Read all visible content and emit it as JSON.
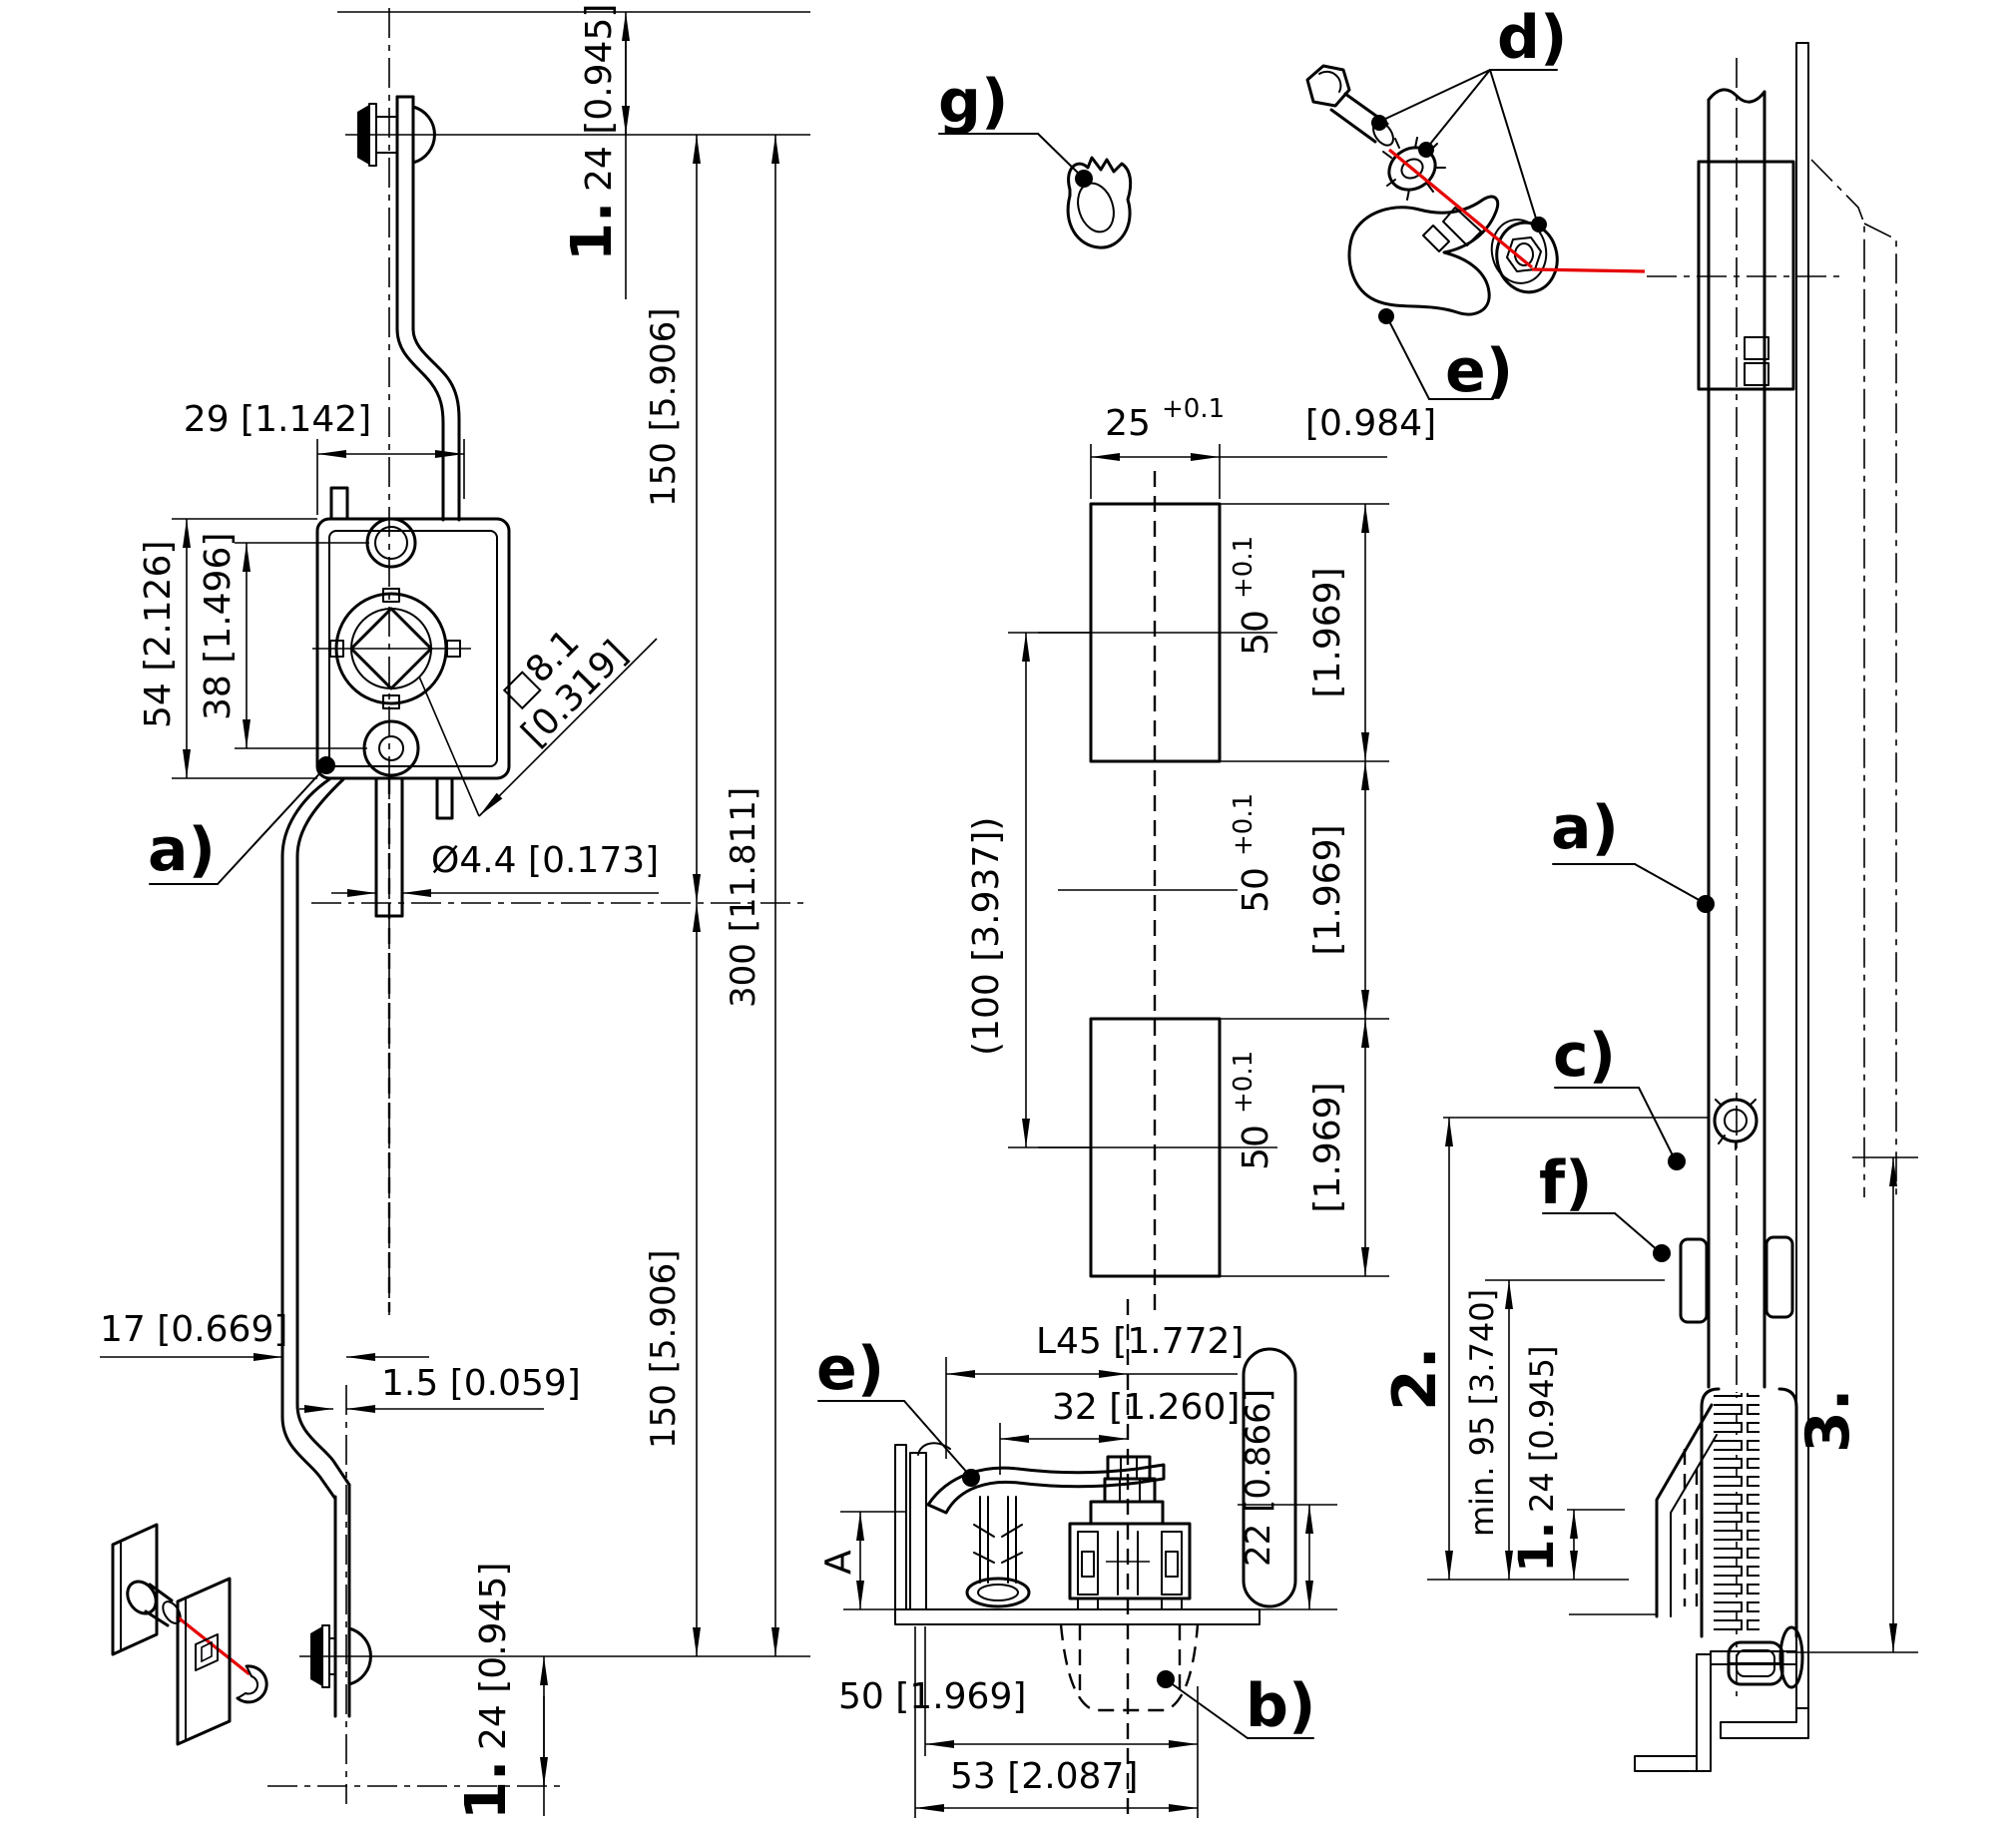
{
  "colors": {
    "line": "#000000",
    "accent": "#e60000",
    "background": "#ffffff"
  },
  "part_labels": {
    "a": "a)",
    "b": "b)",
    "c": "c)",
    "d": "d)",
    "e": "e)",
    "f": "f)",
    "g": "g)"
  },
  "steps": {
    "s1": "1.",
    "s2": "2.",
    "s3": "3."
  },
  "left_view": {
    "d24_top": "24 [0.945]",
    "d150_top": "150 [5.906]",
    "d300": "300 [11.811]",
    "d150_bottom": "150 [5.906]",
    "d24_bottom": "24 [0.945]",
    "d29": "29 [1.142]",
    "d54": "54 [2.126]",
    "d38": "38 [1.496]",
    "d8_1_sq": "□8.1",
    "d8_1_in": "[0.319]",
    "d4_4": "Ø4.4 [0.173]",
    "d17": "17 [0.669]",
    "d1_5": "1.5 [0.059]"
  },
  "cutout_view": {
    "d25": {
      "value": "25",
      "tol": "+0.1",
      "inch": "[0.984]"
    },
    "d50_top": {
      "value": "50",
      "tol": "+0.1",
      "inch": "[1.969]"
    },
    "d50_mid": {
      "value": "50",
      "tol": "+0.1",
      "inch": "[1.969]"
    },
    "d50_bottom": {
      "value": "50",
      "tol": "+0.1",
      "inch": "[1.969]"
    },
    "d100": "(100 [3.937])"
  },
  "section_view": {
    "dL45": "L45 [1.772]",
    "d32": "32 [1.260]",
    "d22": "22 [0.866]",
    "dA": "A",
    "d50": "50 [1.969]",
    "d53": "53 [2.087]"
  },
  "side_view": {
    "min95": "min. 95 [3.740]",
    "d24": "24 [0.945]"
  }
}
